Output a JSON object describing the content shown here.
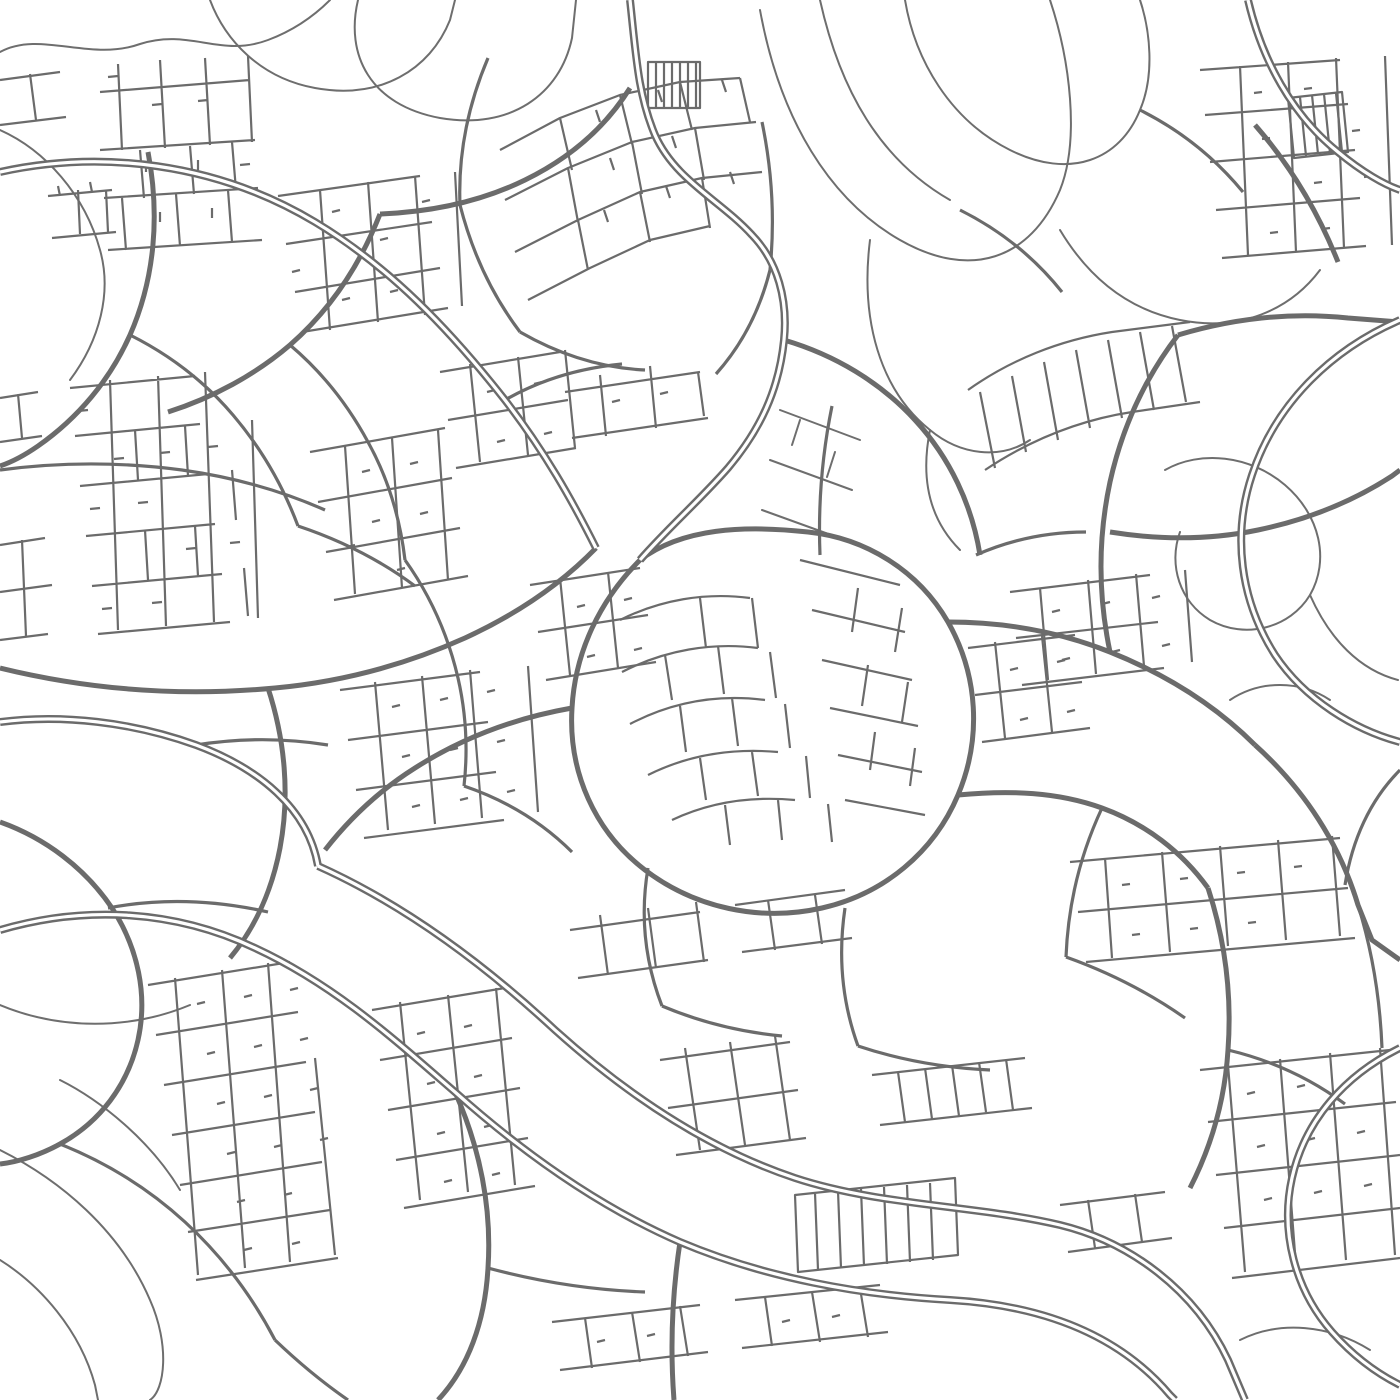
{
  "map": {
    "canvas": {
      "width": 1400,
      "height": 1400,
      "background": "#ffffff",
      "road_color": "#6b6b6b"
    },
    "layers": [
      {
        "name": "trails",
        "width": 2,
        "color": "#6e6e6e",
        "cap": "round",
        "paths": [
          "M0,52 C40,30 90,62 140,44 C190,28 220,58 268,40 C300,28 320,10 330,0",
          "M210,0 C225,40 260,78 315,88 C380,100 430,70 450,20 L455,0",
          "M358,0 C345,55 370,105 440,118 C510,130 560,95 572,38 L576,0",
          "M0,130 C45,150 85,195 100,250 C112,292 100,340 70,380",
          "M760,10 C780,120 830,200 900,240 C970,280 1030,260 1060,190 C1080,140 1070,60 1050,0",
          "M905,0 C915,60 950,120 1010,150 C1070,180 1120,160 1140,110 C1155,75 1150,30 1140,0",
          "M820,0 C840,90 880,160 950,200",
          "M1060,230 C1090,280 1130,310 1180,320 C1240,332 1290,310 1320,270",
          "M870,240 C860,320 880,390 930,430 C960,455 1000,460 1030,440",
          "M930,430 C920,480 930,520 960,550",
          "M0,1150 C60,1180 120,1230 150,1300 C170,1345 165,1390 150,1400",
          "M0,1260 C40,1285 80,1330 95,1385 L98,1400",
          "M60,1080 C100,1100 150,1140 180,1190",
          "M0,1005 C60,1030 130,1030 190,1005",
          "M1165,470 C1200,450 1250,455 1285,485 C1320,515 1330,560 1310,595 C1290,628 1245,640 1210,620 C1180,602 1168,565 1180,532",
          "M1230,700 C1260,680 1300,680 1330,700",
          "M1310,595 C1330,640 1360,670 1398,680",
          "M1240,1340 C1280,1320 1330,1325 1370,1350",
          "M780,410 L860,440 M770,460 L852,490 M762,510 L845,540 M800,420 L792,445 M835,452 L827,477"
        ]
      },
      {
        "name": "minor",
        "width": 2.2,
        "cap": "butt",
        "paths": [
          "M100,92 L250,80 M118,64 L122,150 M160,60 L165,148 M205,58 L210,145 M248,56 L252,142 M100,150 L255,140 M104,198 L258,188 M108,250 L262,240 M140,150 L144,198 M190,146 L194,194 M232,142 L236,190 M122,198 L126,250 M176,194 L180,246 M228,190 L232,242 M118,76 L108,77 M162,104 L152,105 M208,100 L198,101 M146,172 L146,162 M198,170 L198,160 M250,164 L240,165 M160,222 L160,212 M212,218 L212,208",
          "M48,196 L112,190 M52,238 L116,232 M78,190 L80,234 M106,190 L108,232 M60,196 L58,186 M92,192 L90,182",
          "M0,80 L60,72 M0,125 L66,117 M30,74 L36,120",
          "M278,196 L420,176 M286,244 L432,222 M295,292 L440,268 M302,332 L448,308 M320,190 L330,330 M368,182 L378,322 M415,176 L425,315 M455,172 L462,306 M340,210 L332,212 M388,238 L380,240 M430,200 L422,202 M300,270 L292,272 M350,298 L342,300 M398,290 L390,292",
          "M500,150 L560,118 L620,95 L680,82 L740,78 M505,200 L568,168 L632,142 L695,128 L756,122 M515,252 L578,220 L640,192 L702,178 L762,172 M528,300 L590,268 L650,240 L710,226 M560,118 L572,170 M620,95 L632,144 M680,82 L692,130 M740,78 L750,122 M568,168 L578,222 M632,142 L642,194 M695,128 L704,180 M578,220 L588,270 M640,192 L650,242 M702,178 L710,228 M596,110 L600,122 M658,90 L662,102 M722,80 L726,92 M610,158 L614,170 M672,136 L676,148 M604,210 L608,222 M666,186 L670,198 M730,172 L734,184",
          "M648,62 L700,62 L700,108 L648,108 Z M656,62 L656,108 M664,62 L664,108 M672,62 L672,108 M680,62 L680,108 M688,62 L688,108 M696,62 L696,108",
          "M565,392 L700,372 M572,438 L708,418 M600,375 L606,436 M650,366 L656,428 M698,372 L704,416 M620,400 L612,402 M668,392 L660,394",
          "M70,388 L195,376 M75,436 L200,424 M80,486 L208,474 M86,536 L215,524 M92,586 L222,574 M98,634 L230,622 M110,380 L118,630 M158,376 L166,626 M205,372 L214,622 M252,420 L258,618 M135,430 L138,480 M185,426 L188,476 M232,470 L236,520 M145,530 L148,580 M195,526 L198,576 M244,568 L248,616 M88,410 L78,411 M124,458 L114,459 M170,452 L160,453 M218,446 L208,447 M100,508 L90,509 M148,502 L138,503 M196,548 L186,549 M240,542 L230,543 M112,608 L102,609 M162,602 L152,603",
          "M310,452 L445,428 M318,502 L452,478 M326,552 L460,528 M334,600 L468,576 M345,446 L355,594 M392,438 L402,588 M438,430 L448,580 M370,470 L362,472 M418,462 L410,464 M380,520 L372,522 M428,512 L420,514 M355,545 L347,547 M405,568 L397,570",
          "M440,372 L560,352 M448,420 L568,400 M456,468 L576,448 M470,364 L480,462 M518,357 L528,455 M565,350 L575,448 M495,390 L487,392 M542,382 L534,384 M505,440 L497,442 M552,432 L544,434",
          "M530,585 L640,568 M538,632 L648,615 M546,680 L656,662 M560,578 L570,675 M608,572 L618,668 M585,605 L577,607 M632,598 L624,600 M595,655 L587,657 M642,648 L634,650",
          "M620,620 C660,600 705,592 750,598 M622,672 C665,650 712,642 758,648 M630,724 C672,702 718,694 765,700 M648,775 C688,755 732,748 778,752 M672,820 C710,802 752,796 795,800 M700,598 L706,648 M752,598 L758,648 M665,655 L672,700 M718,646 L724,694 M770,652 L776,698 M680,706 L686,752 M732,698 L738,746 M785,704 L790,748 M700,758 L706,800 M752,752 L758,796 M806,756 L810,798 M725,805 L730,845 M778,800 L782,840 M828,804 L832,842",
          "M800,560 L900,585 M812,610 L905,632 M822,660 L912,680 M830,708 L918,726 M838,755 L922,772 M845,800 L925,815 M858,588 L852,632 M902,608 L895,652 M868,665 L862,706 M908,682 L902,722 M875,732 L870,770 M915,748 L910,786",
          "M1200,70 L1340,60 M1205,115 L1348,104 M1210,162 L1355,150 M1216,210 L1360,198 M1222,258 L1366,246 M1240,66 L1248,255 M1288,62 L1296,252 M1336,58 L1344,248 M1385,56 L1392,245 M1262,92 L1254,93 M1312,88 L1304,89 M1360,130 L1352,131 M1270,138 L1262,139 M1322,182 L1314,183 M1372,176 L1364,177 M1278,232 L1270,233 M1330,228 L1322,229",
          "M1288,98 L1342,92 L1348,152 L1294,158 Z M1300,97 L1306,156 M1312,95 L1318,154 M1324,94 L1330,153 M1336,93 L1342,152",
          "M968,390 C1010,360 1060,340 1112,332 L1190,322 M985,470 C1030,440 1080,420 1132,412 L1200,402 M980,392 L995,468 M1012,376 L1026,452 M1044,362 L1058,440 M1076,350 L1090,428 M1108,340 L1122,418 M1140,332 L1154,410 M1172,326 L1186,402",
          "M1010,592 L1150,575 M1016,638 L1158,622 M1022,685 L1164,668 M1040,588 L1048,680 M1088,580 L1096,674 M1136,574 L1144,666 M1185,570 L1192,662 M1060,610 L1052,612 M1110,602 L1102,604 M1160,596 L1152,598 M1070,658 L1062,660 M1120,650 L1112,652 M1170,644 L1162,646",
          "M968,648 L1075,635 M975,695 L1082,682 M982,742 L1090,728 M995,642 L1005,738 M1042,636 L1052,732 M1018,668 L1010,670 M1065,660 L1057,662 M1028,718 L1020,720 M1075,710 L1067,712",
          "M1070,862 L1340,838 M1078,912 L1348,888 M1086,962 L1355,938 M1105,858 L1112,958 M1162,852 L1170,952 M1220,846 L1228,946 M1278,840 L1286,940 M1332,836 L1340,936 M1130,884 L1122,885 M1188,878 L1180,879 M1245,872 L1237,873 M1302,866 L1294,867 M1140,934 L1132,935 M1198,928 L1190,929 M1256,922 L1248,923",
          "M148,985 L290,962 M156,1035 L298,1012 M164,1085 L306,1062 M172,1135 L315,1112 M180,1185 L322,1162 M188,1232 L330,1210 M196,1280 L338,1258 M175,978 L198,1275 M222,970 L245,1268 M268,963 L290,1262 M315,1058 L335,1255 M205,1002 L197,1004 M252,995 L244,997 M298,988 L290,990 M215,1052 L207,1054 M262,1045 L254,1047 M308,1038 L300,1040 M225,1102 L217,1104 M272,1095 L264,1097 M318,1088 L310,1090 M235,1152 L227,1154 M282,1145 L274,1147 M328,1138 L320,1140 M245,1200 L237,1202 M292,1193 L284,1195 M252,1248 L244,1250 M300,1242 L292,1244",
          "M372,1010 L505,988 M380,1060 L512,1038 M388,1110 L520,1088 M396,1160 L528,1138 M404,1208 L535,1186 M400,1002 L420,1200 M448,995 L468,1192 M496,988 L515,1185 M425,1032 L417,1034 M472,1025 L464,1027 M435,1082 L427,1084 M482,1075 L474,1077 M445,1132 L437,1134 M492,1125 L484,1127 M452,1180 L444,1182 M500,1173 L492,1175",
          "M660,1060 L790,1042 M668,1108 L798,1090 M676,1155 L806,1138 M685,1048 L700,1150 M730,1042 L745,1145 M775,1036 L790,1140",
          "M795,1195 L955,1178 L958,1255 L798,1272 Z M815,1193 L818,1270 M838,1191 L841,1268 M861,1189 L864,1266 M884,1187 L887,1264 M907,1185 L910,1262 M930,1183 L933,1260",
          "M872,1075 L1025,1058 M880,1125 L1032,1108 M898,1072 L905,1122 M925,1068 L932,1119 M952,1065 L959,1116 M979,1062 L986,1112 M1006,1059 L1013,1110",
          "M1200,1070 L1390,1050 M1208,1122 L1396,1102 M1216,1175 L1400,1155 M1224,1228 L1400,1208 M1232,1278 L1400,1258 M1228,1065 L1245,1272 M1280,1059 L1296,1266 M1330,1053 L1346,1260 M1380,1048 L1395,1255 M1255,1092 L1247,1094 M1305,1085 L1297,1087 M1355,1078 L1347,1080 M1265,1145 L1257,1147 M1315,1138 L1307,1140 M1365,1131 L1357,1133 M1272,1198 L1264,1200 M1322,1191 L1314,1193 M1372,1184 L1364,1186",
          "M552,1322 L700,1305 M560,1370 L708,1352 M585,1318 L592,1368 M632,1312 L640,1362 M680,1306 L688,1356 M735,1300 L880,1285 M742,1348 L888,1332 M765,1297 L772,1346 M812,1292 L820,1342 M860,1288 L868,1337 M605,1340 L597,1342 M655,1334 L647,1336 M790,1320 L782,1322 M840,1315 L832,1317",
          "M0,545 L45,538 M0,592 L52,585 M0,640 L48,634 M22,540 L26,636 M0,398 L38,392 M0,442 L42,436 M18,394 L22,438",
          "M340,690 L480,672 M348,740 L488,722 M356,790 L496,772 M364,838 L504,820 M375,682 L388,830 M422,676 L435,824 M470,670 L482,818 M528,666 L538,812 M400,705 L392,707 M448,698 L440,700 M495,690 L487,692 M410,755 L402,757 M458,748 L450,750 M505,740 L497,742 M420,805 L412,807 M468,798 L460,800 M515,790 L507,792",
          "M570,930 L700,912 M578,978 L708,960 M600,915 L608,975 M648,908 L656,968 M696,902 L704,962 M735,905 L845,890 M742,952 L852,938 M768,900 L775,950 M815,895 L822,944",
          "M1060,1205 L1165,1192 M1068,1252 L1172,1238 M1088,1200 L1095,1248 M1135,1194 L1142,1242"
        ]
      },
      {
        "name": "collector",
        "width": 3.2,
        "cap": "butt",
        "paths": [
          "M505,400 C540,380 580,368 622,364",
          "M290,345 C322,372 348,405 368,442 C388,478 400,518 405,560",
          "M405,560 C430,595 448,635 458,678 C466,713 468,750 464,786",
          "M464,786 C505,800 542,822 572,852",
          "M196,745 C240,738 285,738 328,745",
          "M108,908 C160,898 215,900 268,912",
          "M845,908 C838,955 842,1002 858,1046",
          "M858,1046 C900,1060 945,1068 990,1070",
          "M1102,808 C1080,855 1068,905 1066,957",
          "M960,210 C1000,230 1035,258 1062,292",
          "M1140,110 C1180,130 1215,158 1243,192",
          "M60,1144 C105,1162 148,1188 185,1222 C222,1256 252,1296 275,1340",
          "M275,1340 C298,1362 322,1382 348,1400",
          "M820,555 C818,505 822,455 832,406",
          "M488,1268 C540,1282 592,1290 645,1292",
          "M1228,1050 C1270,1060 1310,1078 1345,1104",
          "M976,555 C1010,540 1048,532 1086,532",
          "M130,335 C170,355 205,382 233,415 C261,448 283,486 298,526",
          "M298,526 C340,540 380,560 415,586",
          "M648,868 C640,915 645,962 662,1006",
          "M662,1006 C700,1022 740,1032 782,1036",
          "M0,470 C60,462 122,462 182,470 C232,477 280,490 325,510",
          "M1066,957 C1108,972 1148,992 1185,1018",
          "M1358,905 C1372,950 1380,998 1382,1048",
          "M488,58 C468,105 458,155 460,205",
          "M460,205 C472,252 492,295 520,332",
          "M520,332 C560,355 602,368 645,370",
          "M762,122 C772,170 775,220 770,270",
          "M770,270 C760,310 742,345 716,374",
          "M1400,770 C1370,800 1352,840 1345,885"
        ]
      },
      {
        "name": "arterial",
        "width": 5,
        "cap": "butt",
        "paths": [
          "M640,560 C600,600 575,652 572,708 C568,772 595,832 645,870 C695,908 760,922 822,908 C884,894 934,852 958,795 C982,738 978,675 948,622 C918,570 865,538 808,532 C744,525 682,528 640,560",
          "M958,795 C1010,790 1058,792 1102,808 C1146,824 1182,852 1208,888",
          "M948,622 C1005,622 1060,632 1110,652 C1165,674 1215,705 1255,745",
          "M1255,745 C1305,790 1340,845 1358,905 L1372,940 L1400,960",
          "M596,548 C560,585 515,615 465,638 C405,665 340,682 275,688 C180,697 90,690 0,668",
          "M268,688 C285,740 290,795 280,848 C272,890 255,928 230,958",
          "M148,152 C160,215 155,278 130,335 C110,380 78,418 38,446 C25,455 12,462 0,466",
          "M380,214 C430,212 480,202 525,180 C570,158 605,128 630,88",
          "M784,340 C835,355 880,382 915,420 C950,458 972,505 980,555",
          "M1110,652 C1098,595 1098,538 1110,482 C1122,428 1145,378 1178,335",
          "M1178,335 C1235,318 1292,312 1348,318 L1400,322",
          "M1255,125 C1290,165 1318,212 1338,262",
          "M0,822 C45,838 85,868 112,908 C138,948 148,995 138,1040 C128,1085 100,1122 60,1144 C40,1155 18,1162 0,1164",
          "M455,1092 C480,1148 492,1208 488,1268 C485,1322 468,1368 438,1400",
          "M680,1242 C672,1295 670,1348 674,1400",
          "M1208,888 C1225,940 1232,995 1228,1050 C1225,1098 1212,1145 1190,1188",
          "M572,708 C515,718 462,738 415,768 C380,790 350,818 325,850",
          "M380,214 C360,265 330,310 290,345 C255,375 212,398 168,412",
          "M1110,532 C1160,540 1210,540 1258,530 C1306,520 1352,502 1392,476 L1400,470"
        ]
      },
      {
        "name": "expressway",
        "width": 8,
        "cap": "butt",
        "inner_width": 3.2,
        "inner_color": "#ffffff",
        "paths": [
          "M0,172 C100,150 215,162 315,222 C390,267 450,330 505,400 C545,452 572,500 596,548",
          "M630,0 C636,55 638,95 655,135 C675,180 720,200 752,235 C778,262 788,300 784,340 C779,390 760,430 728,468 C700,500 668,528 640,560",
          "M1248,0 C1262,60 1292,115 1338,152 C1362,172 1385,185 1400,190",
          "M1400,320 C1330,350 1275,405 1252,475 C1232,535 1240,600 1275,655 C1305,700 1355,730 1400,742",
          "M0,930 C85,905 175,910 255,948 C335,985 395,1040 455,1092 C520,1150 595,1205 680,1242 C765,1278 860,1295 950,1300 C1035,1305 1115,1330 1170,1395 L1175,1400",
          "M318,866 C405,905 485,965 555,1030 C625,1093 705,1148 795,1178 C880,1206 975,1205 1060,1225 C1130,1242 1195,1290 1228,1360 L1245,1400",
          "M0,722 C62,714 132,722 196,745 C258,768 308,808 318,866",
          "M1400,1048 C1345,1075 1305,1120 1292,1178 C1280,1232 1295,1290 1332,1332 C1355,1358 1380,1375 1400,1385"
        ]
      }
    ]
  }
}
